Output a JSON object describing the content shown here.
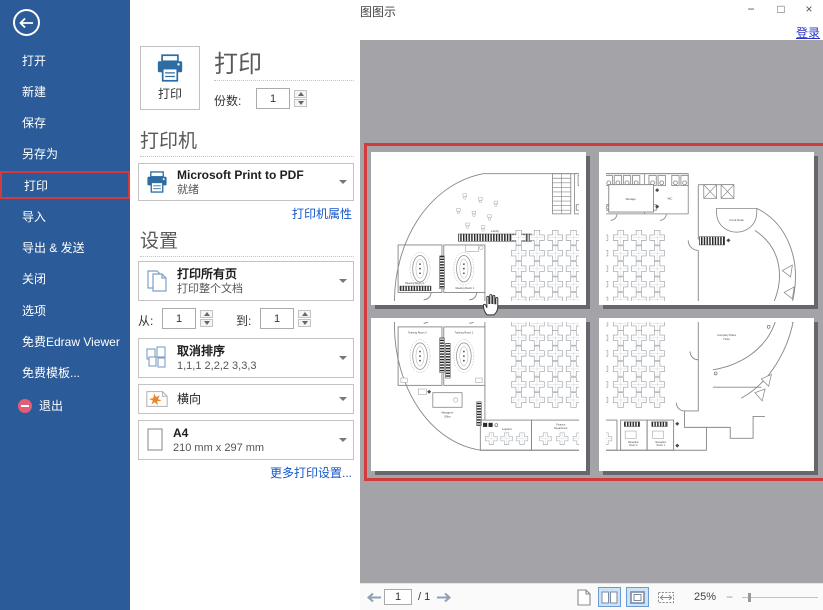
{
  "window": {
    "title": "亿图图示",
    "minimize": "−",
    "maximize": "□",
    "close": "×",
    "login": "登录"
  },
  "sidebar": {
    "items": [
      "打开",
      "新建",
      "保存",
      "另存为",
      "打印",
      "导入",
      "导出 & 发送",
      "关闭",
      "选项",
      "免费Edraw Viewer",
      "免费模板...",
      "退出"
    ]
  },
  "print": {
    "button_label": "打印",
    "heading": "打印",
    "copies_label": "份数:",
    "copies_value": "1"
  },
  "printer": {
    "heading": "打印机",
    "name": "Microsoft Print to PDF",
    "status": "就绪",
    "properties_link": "打印机属性"
  },
  "settings": {
    "heading": "设置",
    "range_title": "打印所有页",
    "range_sub": "打印整个文档",
    "from_label": "从:",
    "from_value": "1",
    "to_label": "到:",
    "to_value": "1",
    "collate_title": "取消排序",
    "collate_sub": "1,1,1  2,2,2  3,3,3",
    "orientation": "横向",
    "paper_title": "A4",
    "paper_sub": "210 mm x 297 mm",
    "more_link": "更多打印设置..."
  },
  "statusbar": {
    "page_current": "1",
    "page_total": "/ 1",
    "zoom": "25%"
  },
  "plan_labels": {
    "wc": "WC",
    "lobby": "Lobby",
    "meeting2": "Meeting Room 2",
    "meeting1": "Meeting Room 1",
    "training2": "Training Room 2",
    "training1": "Training Room 1",
    "manager1": "Manager's",
    "manager2": "Office",
    "logistics": "Logistics",
    "finance1": "Finance",
    "finance2": "Department",
    "rec2a": "Reception",
    "rec2b": "Room 2",
    "rec1a": "Reception",
    "rec1b": "Room 1",
    "storage": "Storage",
    "front_desk": "Front Desk",
    "plaza1": "Company Plaza",
    "plaza2": "Hotel"
  },
  "colors": {
    "sidebar_blue": "#2b5b98",
    "accent_red": "#d23b3b",
    "link_blue": "#1356c9",
    "selected_view_bg": "#cfe3f8",
    "selected_view_border": "#6b9bd2",
    "preview_gray": "#a3a3a8"
  }
}
